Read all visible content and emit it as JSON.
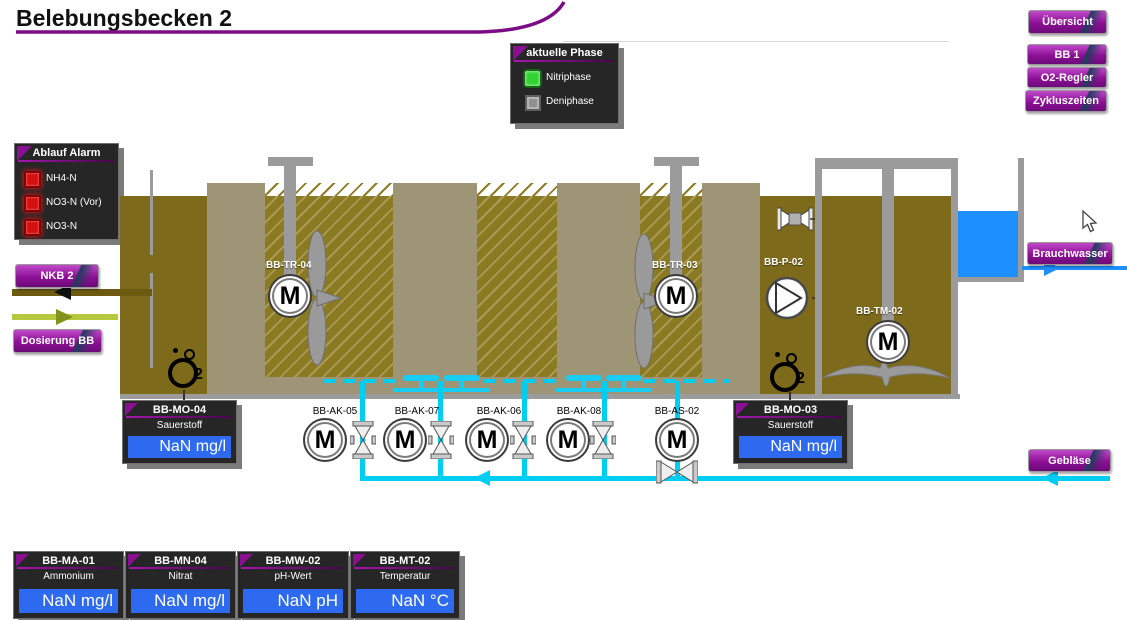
{
  "title": "Belebungsbecken 2",
  "nav": {
    "uebersicht": "Übersicht",
    "bb1": "BB 1",
    "o2regler": "O2-Regler",
    "zykluszeiten": "Zykluszeiten",
    "nkb2": "NKB 2",
    "dosierung": "Dosierung BB",
    "brauchwasser": "Brauchwasser",
    "geblaese": "Gebläse"
  },
  "phase_panel": {
    "title": "aktuelle Phase",
    "items": [
      {
        "label": "Nitriphase",
        "state": "on",
        "color": "#2fd32f"
      },
      {
        "label": "Deniphase",
        "state": "off",
        "color": "#909090"
      }
    ]
  },
  "alarm_panel": {
    "title": "Ablauf Alarm",
    "items": [
      {
        "label": "NH4-N",
        "state": "alarm"
      },
      {
        "label": "NO3-N (Vor)",
        "state": "alarm"
      },
      {
        "label": "NO3-N",
        "state": "alarm"
      }
    ]
  },
  "equipment": {
    "mixer1": "BB-TR-04",
    "mixer2": "BB-TR-03",
    "pump": "BB-P-02",
    "submersible": "BB-TM-02",
    "motor_letter": "M",
    "o2_main": "O",
    "o2_sub": "2",
    "valves": [
      {
        "label": "BB-AK-05"
      },
      {
        "label": "BB-AK-07"
      },
      {
        "label": "BB-AK-06"
      },
      {
        "label": "BB-AK-08"
      },
      {
        "label": "BB-AS-02"
      }
    ]
  },
  "measurements": {
    "mo04": {
      "title": "BB-MO-04",
      "param": "Sauerstoff",
      "value": "NaN mg/l"
    },
    "mo03": {
      "title": "BB-MO-03",
      "param": "Sauerstoff",
      "value": "NaN mg/l"
    },
    "bottom": [
      {
        "title": "BB-MA-01",
        "param": "Ammonium",
        "value": "NaN mg/l"
      },
      {
        "title": "BB-MN-04",
        "param": "Nitrat",
        "value": "NaN mg/l"
      },
      {
        "title": "BB-MW-02",
        "param": "pH-Wert",
        "value": "NaN pH"
      },
      {
        "title": "BB-MT-02",
        "param": "Temperatur",
        "value": "NaN °C"
      }
    ]
  },
  "colors": {
    "accent_purple": "#8a0f93",
    "value_blue": "#2e6af0",
    "pipe_cyan": "#00cdf2",
    "water_blue": "#1e8fff",
    "tank_olive": "#7d6a1b",
    "tank_wall": "#9e9577",
    "led_green": "#2fd32f",
    "led_red": "#d40f0f"
  }
}
